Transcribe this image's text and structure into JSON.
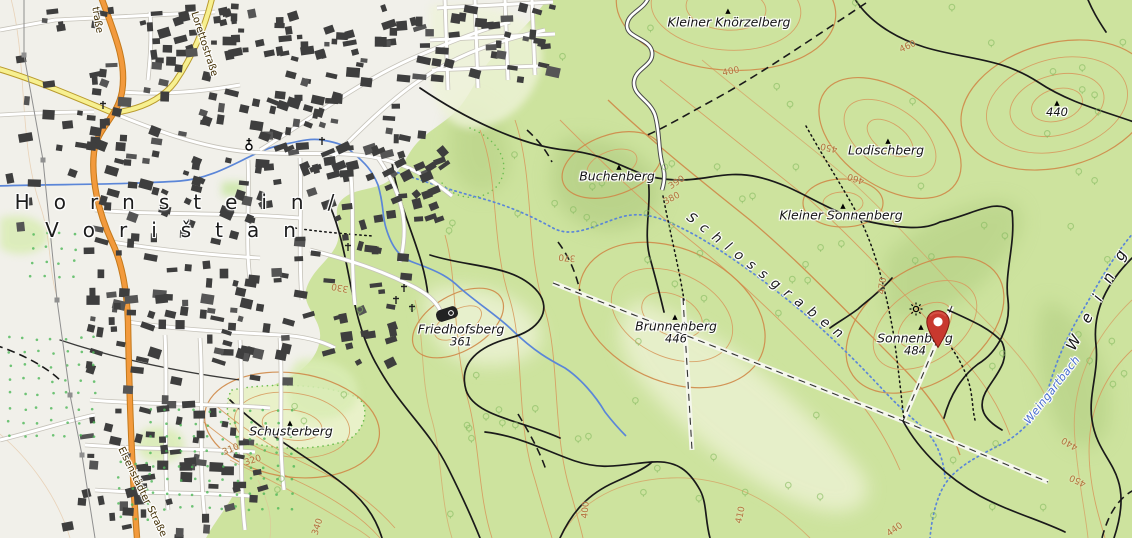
{
  "map": {
    "style": "topographic-osm",
    "town": {
      "name_line1": "Hornstein/",
      "name_line2": "Vorištan",
      "line1_x": 180,
      "line1_y": 202,
      "line2_x": 176,
      "line2_y": 230
    },
    "peaks": [
      {
        "name": "Kleiner Knörzelberg",
        "elevation": "",
        "x": 729,
        "y": 22,
        "tri_x": 728,
        "tri_y": 11
      },
      {
        "name": "Lodischberg",
        "elevation": "",
        "x": 886,
        "y": 150,
        "tri_x": 888,
        "tri_y": 141
      },
      {
        "name": "Buchenberg",
        "elevation": "",
        "x": 617,
        "y": 176,
        "tri_x": 619,
        "tri_y": 167
      },
      {
        "name": "Kleiner Sonnenberg",
        "elevation": "",
        "x": 841,
        "y": 215,
        "tri_x": 843,
        "tri_y": 206
      },
      {
        "name": "Brunnenberg",
        "elevation": "446",
        "x": 676,
        "y": 332,
        "tri_x": 675,
        "tri_y": 317
      },
      {
        "name": "Sonnenberg",
        "elevation": "484",
        "x": 915,
        "y": 344,
        "tri_x": 921,
        "tri_y": 327
      },
      {
        "name": "Friedhofsberg",
        "elevation": "361",
        "x": 461,
        "y": 335,
        "tri_x": -1,
        "tri_y": -1
      },
      {
        "name": "Schusterberg",
        "elevation": "",
        "x": 291,
        "y": 431,
        "tri_x": 290,
        "tri_y": 423
      },
      {
        "name": "",
        "elevation": "440",
        "x": 1057,
        "y": 112,
        "tri_x": 1057,
        "tri_y": 103
      }
    ],
    "water_labels": [
      {
        "name": "Weingartbach",
        "x": 1052,
        "y": 390,
        "rot": -52
      }
    ],
    "valley_labels": [
      {
        "name": "Schlossgraben",
        "x": 768,
        "y": 278,
        "rot": 38
      }
    ],
    "area_labels": [
      {
        "name": "Weing",
        "x": 1100,
        "y": 293,
        "rot": -62
      }
    ],
    "road_labels": [
      {
        "name": "Eisenstädter Straße",
        "x": 142,
        "y": 492,
        "rot": 64
      },
      {
        "name": "Lorettostraße",
        "x": 204,
        "y": 44,
        "rot": 72
      },
      {
        "name": "traße",
        "x": 97,
        "y": 20,
        "rot": 80
      }
    ],
    "contour_labels": [
      {
        "v": "400",
        "x": 731,
        "y": 72,
        "r": -12
      },
      {
        "v": "450",
        "x": 829,
        "y": 147,
        "r": 192
      },
      {
        "v": "460",
        "x": 856,
        "y": 178,
        "r": 198
      },
      {
        "v": "460",
        "x": 908,
        "y": 47,
        "r": -25
      },
      {
        "v": "390",
        "x": 677,
        "y": 183,
        "r": -33
      },
      {
        "v": "380",
        "x": 672,
        "y": 199,
        "r": -28
      },
      {
        "v": "370",
        "x": 567,
        "y": 257,
        "r": 185
      },
      {
        "v": "470",
        "x": 883,
        "y": 286,
        "r": -83
      },
      {
        "v": "330",
        "x": 340,
        "y": 287,
        "r": 190
      },
      {
        "v": "310",
        "x": 231,
        "y": 450,
        "r": -22
      },
      {
        "v": "320",
        "x": 253,
        "y": 461,
        "r": -18
      },
      {
        "v": "340",
        "x": 318,
        "y": 527,
        "r": -72
      },
      {
        "v": "400",
        "x": 586,
        "y": 510,
        "r": -85
      },
      {
        "v": "410",
        "x": 741,
        "y": 515,
        "r": -78
      },
      {
        "v": "440",
        "x": 895,
        "y": 530,
        "r": -35
      },
      {
        "v": "450",
        "x": 1078,
        "y": 480,
        "r": 205
      },
      {
        "v": "440",
        "x": 1070,
        "y": 443,
        "r": 210
      }
    ],
    "marker": {
      "name": "selected-location-pin",
      "tip_x": 938,
      "tip_y": 348,
      "color": "#c8382e",
      "border": "#7e1a10",
      "hole": "#ffffff"
    },
    "poi": {
      "viewpoint": {
        "x": 916,
        "y": 309
      },
      "reservoir": {
        "x": 447,
        "y": 314
      },
      "church": {
        "x": 249,
        "y": 147
      },
      "crosses": [
        [
          103,
          105
        ],
        [
          322,
          141
        ],
        [
          348,
          247
        ],
        [
          396,
          300
        ],
        [
          412,
          308
        ],
        [
          404,
          288
        ]
      ]
    },
    "colors": {
      "forest": "#cde39e",
      "clearing": "#eaf1cd",
      "urban": "#f1f0ea",
      "building": "#3e3e3e",
      "water": "#5b86d8",
      "contour": "#d79a5e",
      "road_primary": "#f29a3d",
      "road_secondary": "#f7f090"
    }
  }
}
